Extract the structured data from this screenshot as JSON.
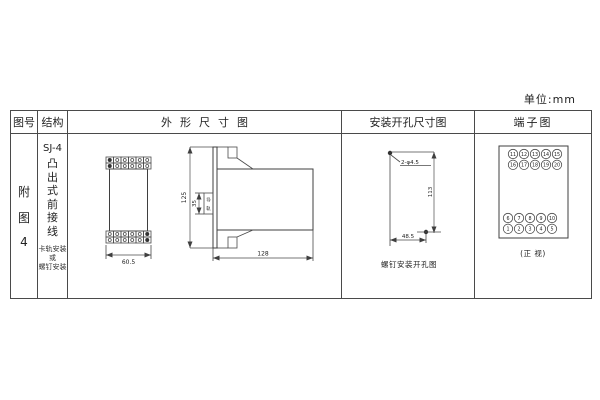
{
  "page": {
    "unit_label": "单位:mm"
  },
  "table": {
    "headers": {
      "figure_no": "图号",
      "structure": "结构",
      "outline": "外形尺寸图",
      "mounting": "安装开孔尺寸图",
      "terminal": "端子图"
    },
    "row": {
      "figure_no_chars": [
        "附",
        "图",
        "4"
      ],
      "structure": {
        "model": "SJ-4",
        "type_chars": [
          "凸",
          "出",
          "式",
          "前",
          "接",
          "线"
        ],
        "mount_note_lines": [
          "卡轨安装",
          "或",
          "螺钉安装"
        ]
      }
    }
  },
  "outline_drawing": {
    "front_width": "60.5",
    "height": "125",
    "rail_width": "35",
    "rail_label_chars": [
      "导",
      "轨"
    ],
    "depth": "128"
  },
  "mounting_drawing": {
    "holes_label": "2-φ4.5",
    "vertical_spacing": "113",
    "horizontal_spacing": "48.5",
    "caption": "螺钉安装开孔图"
  },
  "terminal_diagram": {
    "top_rows": [
      [
        "11",
        "12",
        "13",
        "14",
        "15"
      ],
      [
        "16",
        "17",
        "18",
        "19",
        "20"
      ]
    ],
    "bottom_rows": [
      [
        "6",
        "7",
        "8",
        "9",
        "10"
      ],
      [
        "1",
        "2",
        "3",
        "4",
        "5"
      ]
    ],
    "caption": "(正 视)"
  }
}
